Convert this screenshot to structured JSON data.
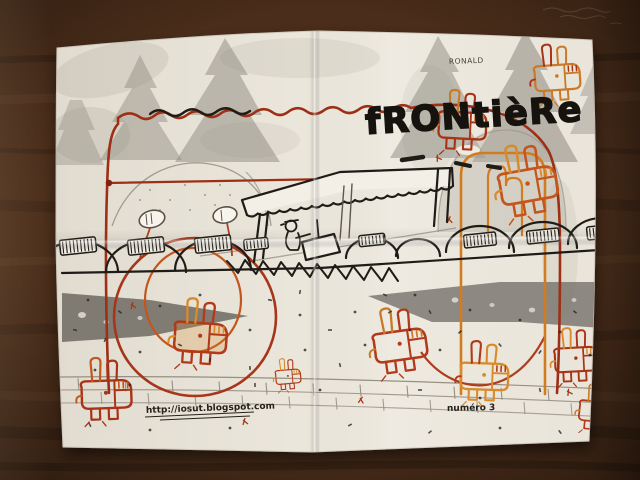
{
  "type": "photograph",
  "subject": "hand-drawn zine page on a folded sheet of paper lying on a dark wooden table",
  "artwork": {
    "title": "fRONtièRe",
    "artist_signature": "RONALD",
    "blog_url": "http://iosut.blogspot.com",
    "issue_label": "numéro 3"
  },
  "scene_elements": [
    "graphite pine trees along the top",
    "border checkpoint with scalloped awning and guard at a desk",
    "zigzag spike strip at the crossing",
    "row of rounded hills with striped hatch patches",
    "two dark crocodile-like watercolor silhouettes",
    "red and orange blocky rabbit doodles scattered around",
    "large red and orange rounded frames drawn over the scene",
    "brick wall band along the bottom",
    "vertical and horizontal fold creases in the paper"
  ],
  "palette": {
    "wood_table": "#4a2d1a",
    "paper": "#ebe6db",
    "ink_black": "#16130e",
    "ink_red": "#a83418",
    "ink_orange": "#d98a2b",
    "graphite_gray": "#8e897f"
  }
}
